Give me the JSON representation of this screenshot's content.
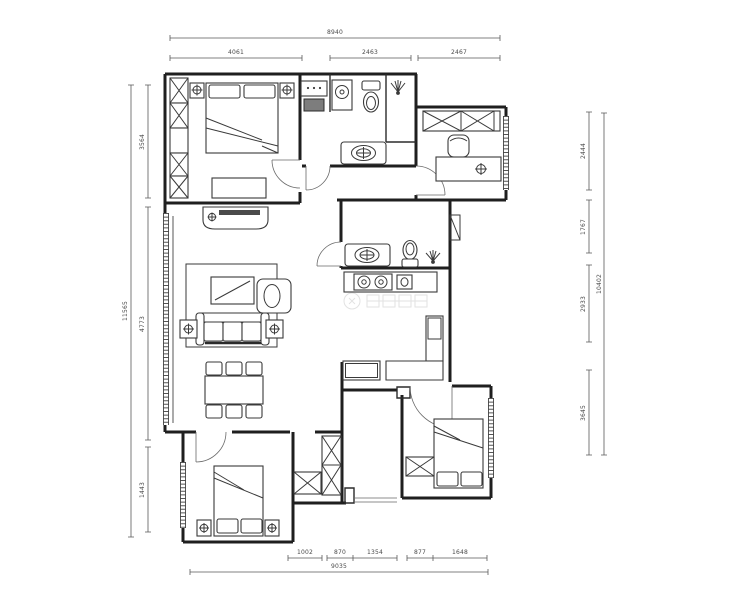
{
  "palette": {
    "paper": "#ffffff",
    "ink": "#1f1f1f",
    "dim_ink": "#4a4a4a"
  },
  "dimensions": {
    "top": {
      "overall": "8940",
      "segments": [
        "4061",
        "2463",
        "2467"
      ]
    },
    "left": {
      "overall": "11565",
      "segments": [
        "3564",
        "4773",
        "1443"
      ]
    },
    "right": {
      "overall": "10402",
      "segments": [
        "2444",
        "1767",
        "2933",
        "3645"
      ]
    },
    "bottom": {
      "overall": "9035",
      "segments": [
        "1002",
        "870",
        "1354",
        "877",
        "1648"
      ]
    }
  }
}
